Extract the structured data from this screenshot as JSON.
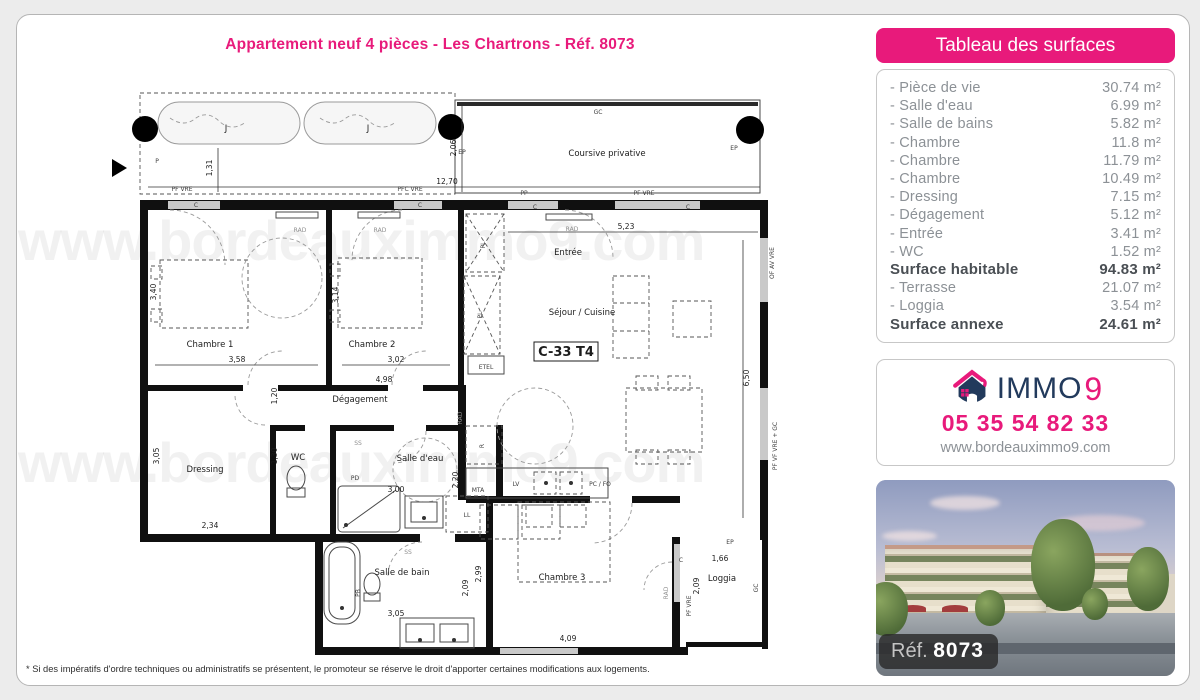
{
  "page": {
    "title": "Appartement neuf 4 pièces - Les Chartrons - Réf. 8073",
    "watermark": "www.bordeauximmo9.com",
    "footnote": "* Si des impératifs d'ordre techniques ou administratifs se présentent, le promoteur se réserve le droit d'apporter certaines modifications aux logements."
  },
  "colors": {
    "accent": "#e81a7b",
    "navy": "#223a5c"
  },
  "surfaces_panel": {
    "title": "Tableau des surfaces",
    "rows": [
      {
        "label": "- Pièce de vie",
        "value": "30.74 m²"
      },
      {
        "label": "- Salle d'eau",
        "value": "6.99 m²"
      },
      {
        "label": "- Salle de bains",
        "value": "5.82 m²"
      },
      {
        "label": "- Chambre",
        "value": "11.8 m²"
      },
      {
        "label": "- Chambre",
        "value": "11.79 m²"
      },
      {
        "label": "- Chambre",
        "value": "10.49 m²"
      },
      {
        "label": "- Dressing",
        "value": "7.15 m²"
      },
      {
        "label": "- Dégagement",
        "value": "5.12 m²"
      },
      {
        "label": "- Entrée",
        "value": "3.41 m²"
      },
      {
        "label": "- WC",
        "value": "1.52 m²"
      },
      {
        "label": "Surface habitable",
        "value": "94.83 m²"
      },
      {
        "label": "- Terrasse",
        "value": "21.07 m²"
      },
      {
        "label": "- Loggia",
        "value": "3.54 m²"
      },
      {
        "label": "Surface annexe",
        "value": "24.61 m²"
      }
    ]
  },
  "agency": {
    "brand": "IMMO",
    "brand_digit": "9",
    "phone": "05 35 54 82 33",
    "website": "www.bordeauximmo9.com"
  },
  "photo": {
    "ref_label": "Réf.",
    "ref_value": "8073"
  },
  "plan": {
    "unit_code": "C-33 T4",
    "labels": {
      "chambre1": "Chambre 1",
      "chambre2": "Chambre 2",
      "chambre3": "Chambre 3",
      "sejour": "Séjour / Cuisine",
      "entree": "Entrée",
      "degagement": "Dégagement",
      "dressing": "Dressing",
      "wc": "WC",
      "salle_eau": "Salle d'eau",
      "salle_bain": "Salle de bain",
      "loggia": "Loggia",
      "coursive": "Coursive privative",
      "planter": "J"
    },
    "equipment": {
      "rad": "RAD",
      "pl": "PL",
      "etel": "ETEL",
      "lv": "LV",
      "pcfo": "PC / FO",
      "r": "R",
      "mta": "MTA",
      "ll": "LL",
      "pd": "PD",
      "pb": "PB",
      "ss": "SS"
    },
    "wall_labels": {
      "pf_vre": "PF VRE",
      "pfc_vre": "PFC VRE",
      "pp": "PP",
      "gc": "GC",
      "ep": "EP",
      "p": "P",
      "c": "C",
      "of_av_vre": "OF AV VRE",
      "pf_vf_vre_gc": "PF VF VRE + GC"
    },
    "dims": {
      "total_w": "12,70",
      "coursive_depth": "2,06",
      "terrace_depth": "1,31",
      "sejour_w": "5,23",
      "sejour_h": "6,50",
      "ch1_h": "3,40",
      "ch1_w": "3,58",
      "ch2_h": "3,14",
      "ch2_w": "3,02",
      "corridor_w": "4,98",
      "wc_w": "1,20",
      "wc_h": "1,30",
      "dressing_h": "3,05",
      "dressing_w": "2,34",
      "sde_w": "3,00",
      "sde_h": "2,20",
      "sdb_w": "3,05",
      "sdb_h": "2,09",
      "ch3_h": "2,99",
      "ch3_w": "4,09",
      "loggia_w": "1,66",
      "loggia_h": "2,09"
    }
  }
}
